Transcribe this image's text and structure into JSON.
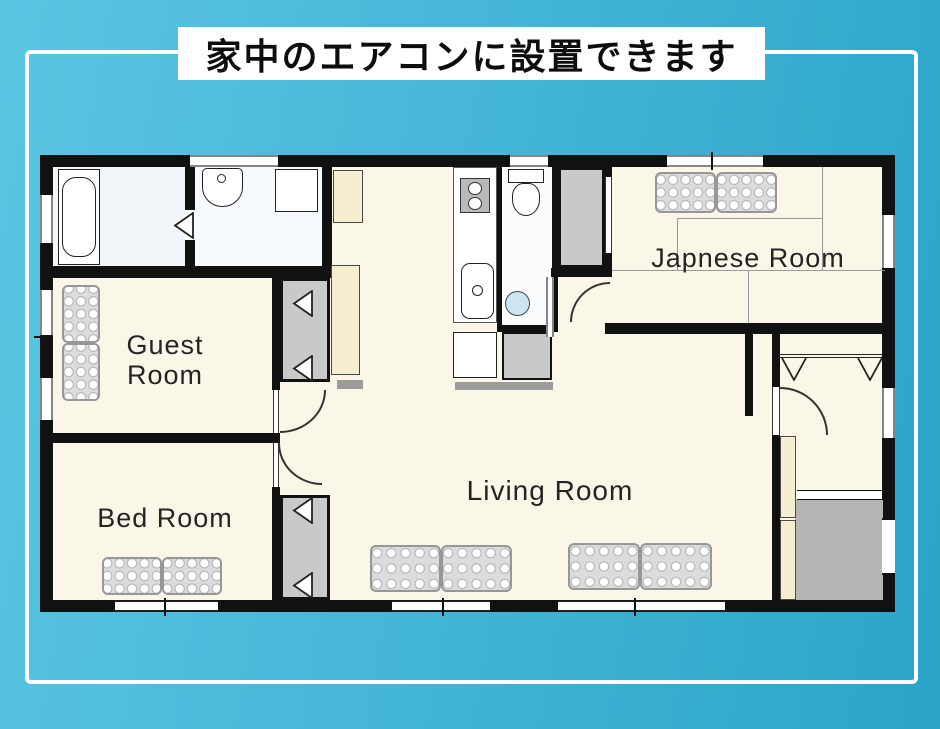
{
  "banner": {
    "title": "家中のエアコンに設置できます"
  },
  "plan": {
    "rooms": {
      "guest": {
        "label": "Guest Room"
      },
      "bed": {
        "label": "Bed Room"
      },
      "living": {
        "label": "Living Room"
      },
      "japanese": {
        "label": "Japnese Room"
      }
    }
  },
  "icons": {
    "bathtub-icon": "rounded-rect outline",
    "washbasin-icon": "half-round basin with faucet dot",
    "washing-machine-icon": "square outline",
    "stove-icon": "gray square with two burner circles",
    "kitchen-sink-icon": "rounded rect with faucet dot",
    "toilet-icon": "tank and bowl outline",
    "hand-basin-icon": "blue circle",
    "futon-icon": "gray tufted mat with dot grid",
    "door-swing-icon": "triangle / quarter-circle arc",
    "window-icon": "double line gap in wall"
  },
  "colors": {
    "background_left": "#5ac6e2",
    "background_right": "#2ba4c9",
    "frame": "#ffffff",
    "title_bg": "#ffffff",
    "title_text": "#0d0d0d",
    "wall": "#111111",
    "floor_cream": "#fbf7e8",
    "wet_floor": "#f3f6fb",
    "closet_gray": "#c9c9c9",
    "entrance_gray": "#b6b4b7",
    "futon_gray": "#dcdcdc",
    "cabinet_cream": "#f5eed0",
    "basin_water": "#cde4f2"
  }
}
